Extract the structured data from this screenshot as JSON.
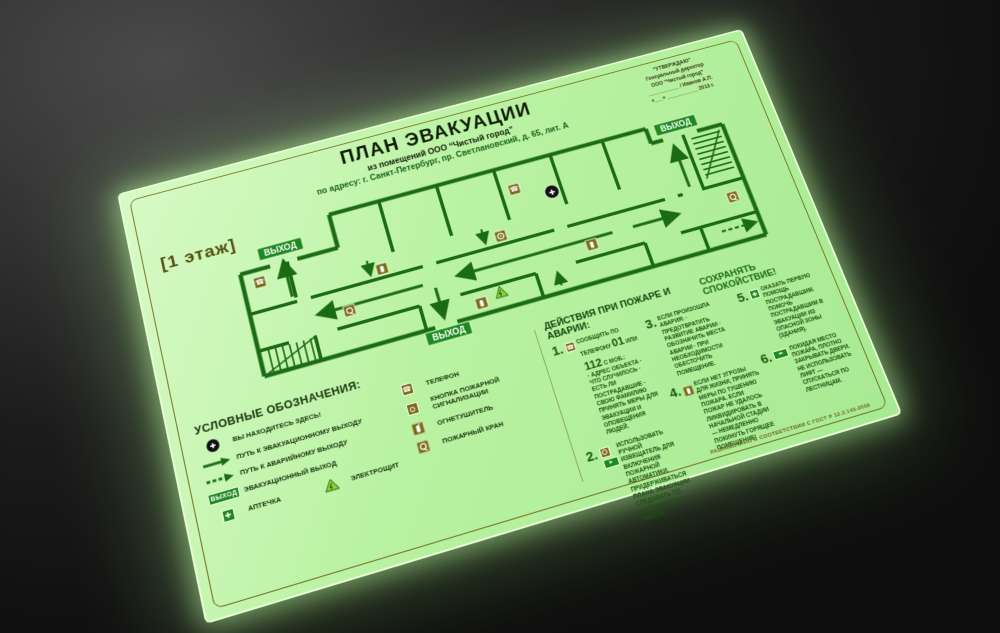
{
  "sign": {
    "title": "ПЛАН ЭВАКУАЦИИ",
    "subtitle": "из помещений ООО “Чистый город”",
    "address": "по адресу: г. Санкт-Петербург, пр. Светлановский, д. 65, лит. А",
    "floor_label": "[1 этаж]",
    "exit_label": "ВЫХОД",
    "approval": {
      "lines": [
        "“УТВЕРЖДАЮ”",
        "Генеральный директор",
        "ООО “Чистый город”",
        "___________ / Иванов А.П.",
        "«___» ___________ 2013 г."
      ]
    },
    "colors": {
      "plate_green": "#b9f2a2",
      "wall_green": "#1b6b15",
      "olive": "#7c6c1a",
      "badge_green": "#1e8a1e"
    },
    "legend": {
      "title": "УСЛОВНЫЕ ОБОЗНАЧЕНИЯ:",
      "items_left": [
        {
          "icon": "you-are-here",
          "label": "ВЫ НАХОДИТЕСЬ ЗДЕСЬ!"
        },
        {
          "icon": "solid-arrow",
          "label": "ПУТЬ К ЭВАКУАЦИОННОМУ ВЫХОДУ"
        },
        {
          "icon": "dashed-arrow",
          "label": "ПУТЬ К АВАРИЙНОМУ ВЫХОДУ"
        },
        {
          "icon": "exit-sign",
          "label": "ЭВАКУАЦИОННЫЙ ВЫХОД"
        },
        {
          "icon": "first-aid",
          "label": "АПТЕЧКА"
        },
        {
          "icon": "electrical-panel",
          "label": "ЭЛЕКТРОЩИТ"
        }
      ],
      "items_right": [
        {
          "icon": "telephone",
          "label": "ТЕЛЕФОН"
        },
        {
          "icon": "fire-alarm-button",
          "label": "КНОПКА ПОЖАРНОЙ СИГНАЛИЗАЦИИ"
        },
        {
          "icon": "fire-extinguisher",
          "label": "ОГНЕТУШИТЕЛЬ"
        },
        {
          "icon": "fire-hose",
          "label": "ПОЖАРНЫЙ КРАН"
        }
      ]
    },
    "actions": {
      "title": "ДЕЙСТВИЯ ПРИ ПОЖАРЕ И АВАРИИ:",
      "subtitle": "СОХРАНЯТЬ СПОКОЙСТВИЕ!",
      "item1": {
        "num": "1.",
        "pre": "СООБЩИТЬ ПО ТЕЛЕФОНУ",
        "phone1": "01",
        "mid": "ИЛИ",
        "phone2": "112",
        "post": "С МОБ.:",
        "details": "· АДРЕС ОБЪЕКТА  · ЧТО СЛУЧИЛОСЬ  · ЕСТЬ ЛИ ПОСТРАДАВШИЕ  · СВОЮ ФАМИЛИЮ",
        "extra": "ПРИНЯТЬ МЕРЫ ДЛЯ ЭВАКУАЦИИ И ОПОВЕЩЕНИЯ ЛЮДЕЙ."
      },
      "items": [
        {
          "num": "2.",
          "text": "ИСПОЛЬЗОВАТЬ РУЧНОЙ ИЗВЕЩАТЕЛЬ ДЛЯ ВКЛЮЧЕНИЯ ПОЖАРНОЙ АВТОМАТИКИ. ПРИДЕРЖИВАТЬСЯ ПЛАНА ЭВАКУАЦИИ. СЛЕДОВАТЬ ПО НАПРАВЛЕНИЮ ЗНАКОВ."
        },
        {
          "num": "3.",
          "text": "ЕСЛИ ПРОИЗОШЛА АВАРИЯ: · ПРЕДОТВРАТИТЬ РАЗВИТИЕ АВАРИИ · ОБОЗНАЧИТЬ МЕСТА АВАРИИ · ПРИ НЕОБХОДИМОСТИ ОБЕСТОЧИТЬ ПОМЕЩЕНИЕ."
        },
        {
          "num": "4.",
          "text": "ЕСЛИ НЕТ УГРОЗЫ ДЛЯ ЖИЗНИ, ПРИНЯТЬ МЕРЫ ПО ТУШЕНИЮ ПОЖАРА. ЕСЛИ ПОЖАР НЕ УДАЛОСЬ ЛИКВИДИРОВАТЬ В НАЧАЛЬНОЙ СТАДИИ — НЕМЕДЛЕННО ПОКИНУТЬ ГОРЯЩЕЕ ПОМЕЩЕНИЕ!"
        },
        {
          "num": "5.",
          "text": "ОКАЗАТЬ ПЕРВУЮ ПОМОЩЬ ПОСТРАДАВШИМ. ПОМОЧЬ ПОСТРАДАВШИМ В ЭВАКУАЦИИ ИЗ ОПАСНОЙ ЗОНЫ (ЗДАНИЯ)."
        },
        {
          "num": "6.",
          "text": "ПОКИДАЯ МЕСТО ПОЖАРА, ПЛОТНО ЗАКРЫВАТЬ ДВЕРИ. НЕ ИСПОЛЬЗОВАТЬ ЛИФТ — СПУСКАТЬСЯ ПО ЛЕСТНИЦАМ."
        }
      ]
    },
    "footnote": "РАЗРАБОТАНО В СООТВЕТСТВИИ С ГОСТ Р 12.2.143-2009"
  }
}
